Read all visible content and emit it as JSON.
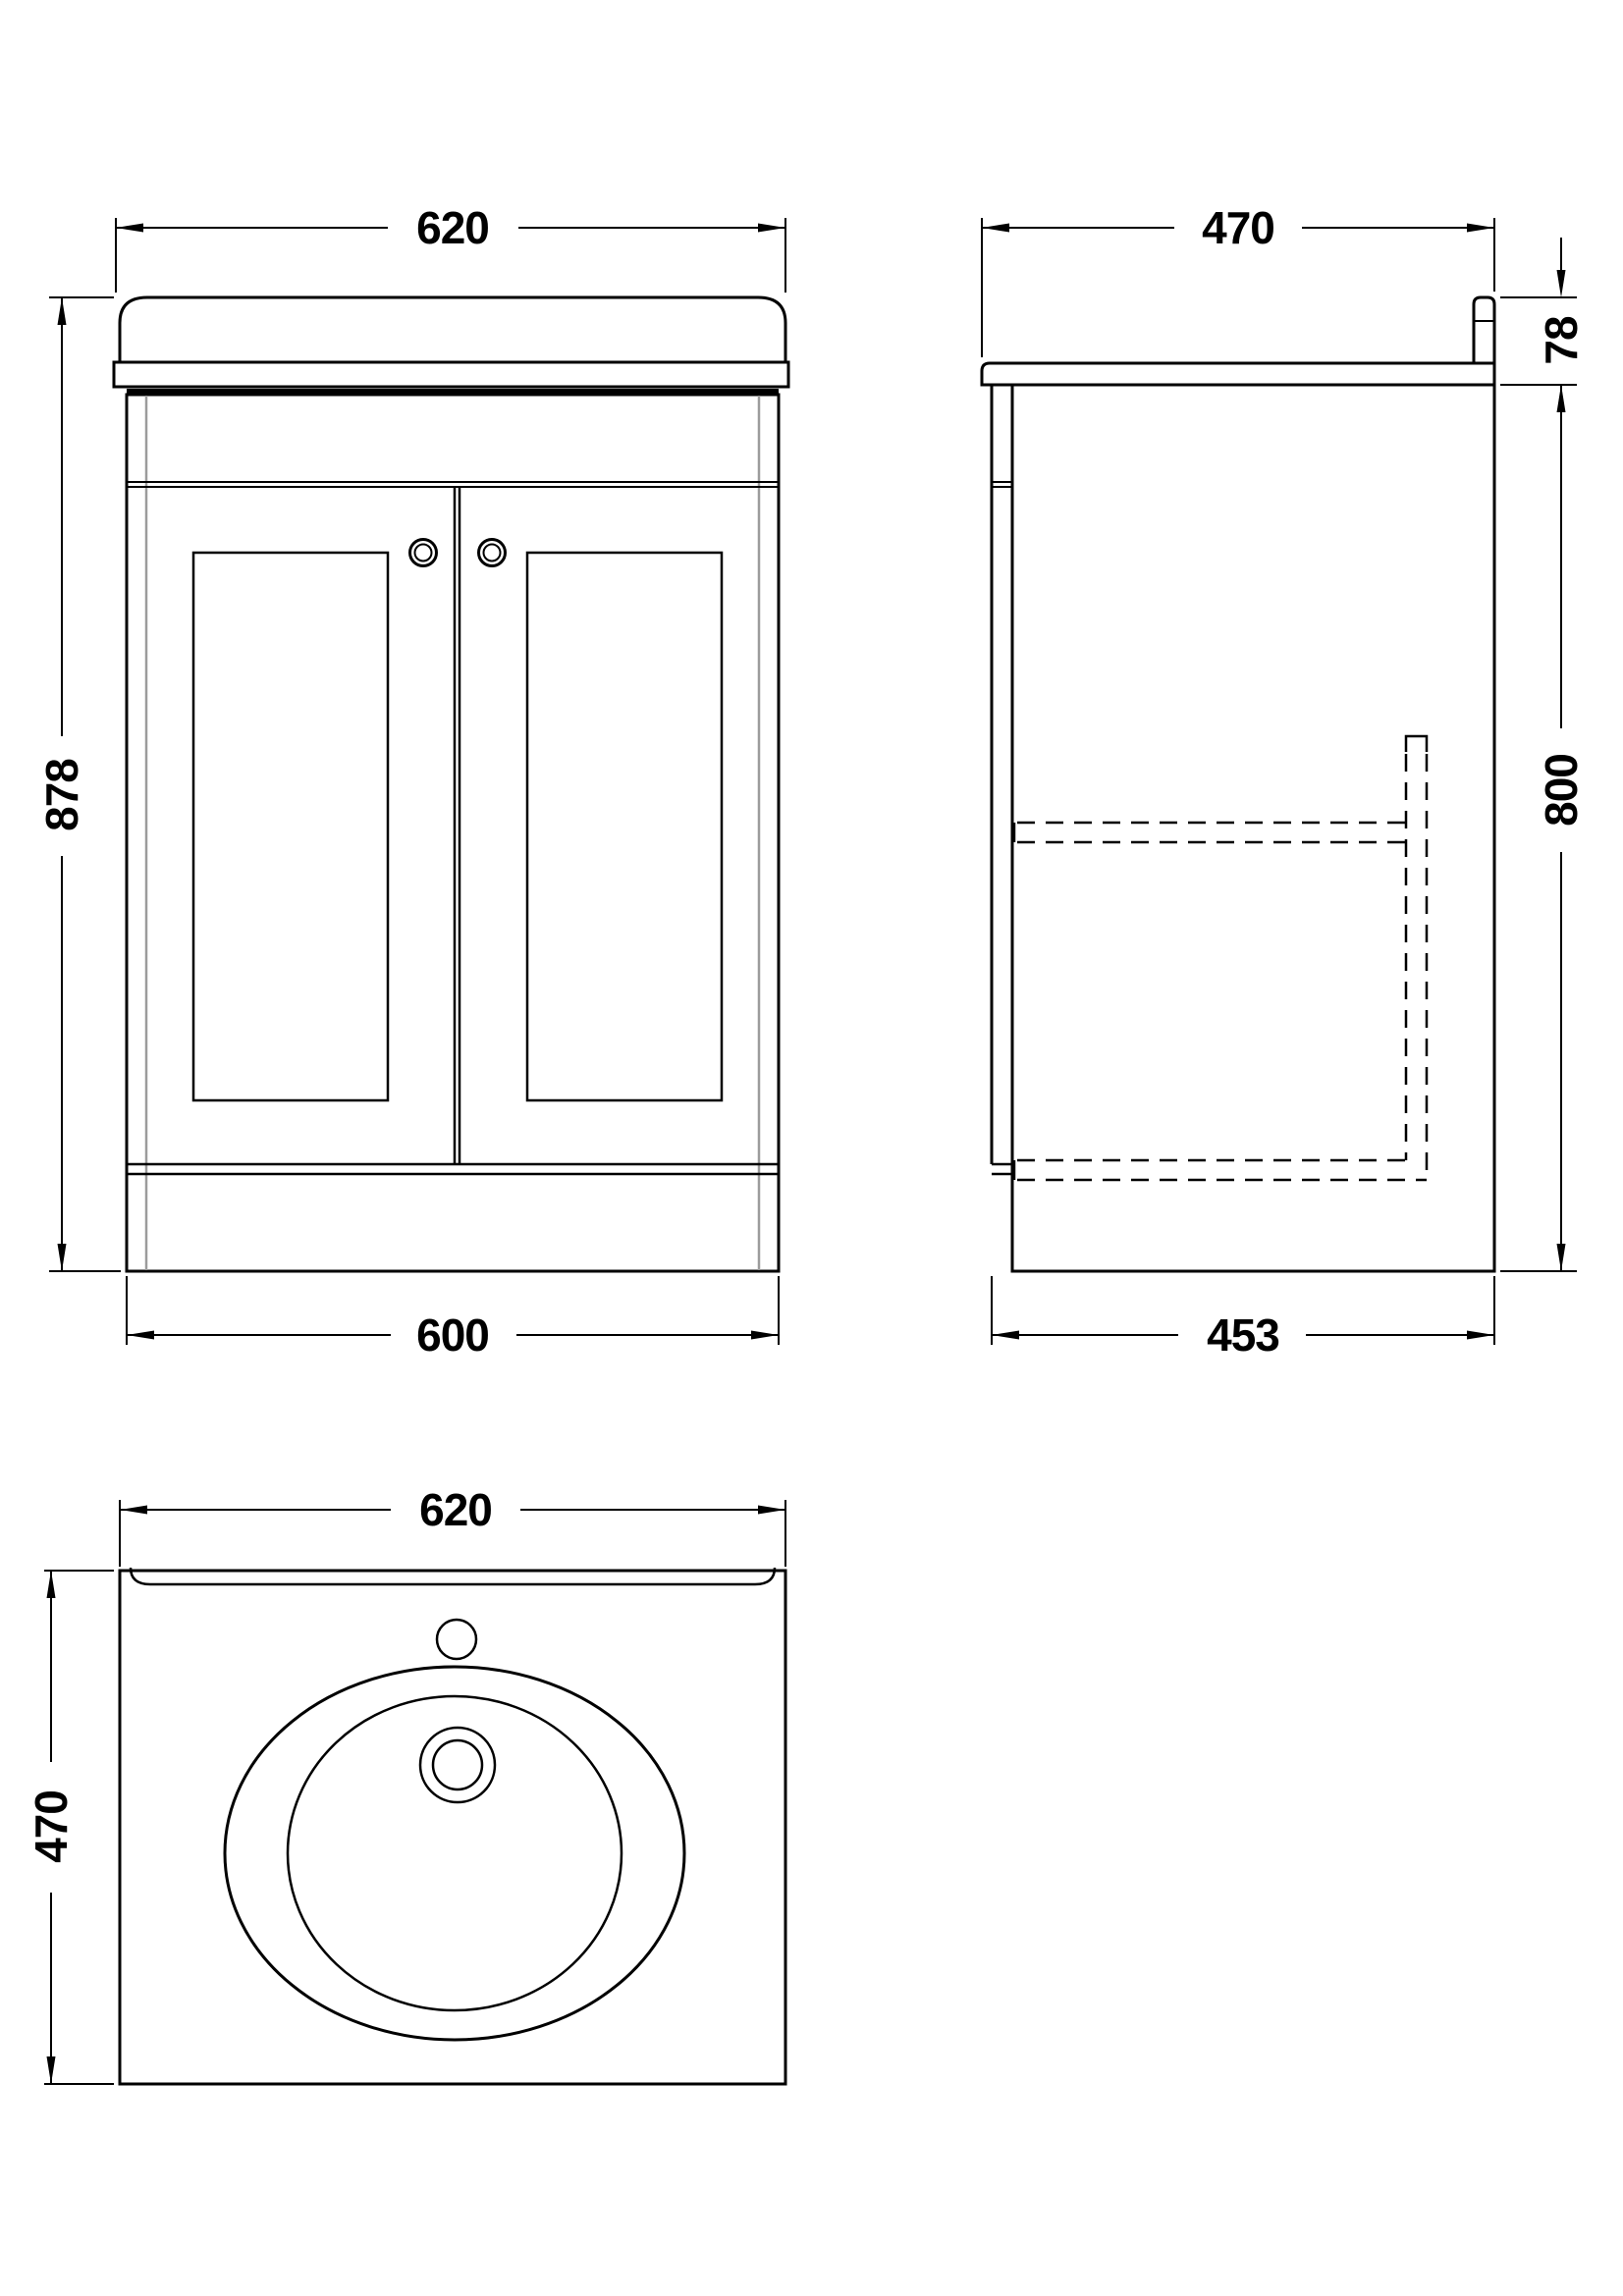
{
  "drawing": {
    "background": "#ffffff",
    "line_color": "#000000",
    "carcass_line_color": "#9c9c9c",
    "front": {
      "top_width": "620",
      "height": "878",
      "bottom_width": "600"
    },
    "side": {
      "top_depth": "470",
      "worktop_height": "78",
      "cabinet_height": "800",
      "bottom_depth": "453"
    },
    "plan": {
      "width": "620",
      "depth": "470"
    }
  }
}
